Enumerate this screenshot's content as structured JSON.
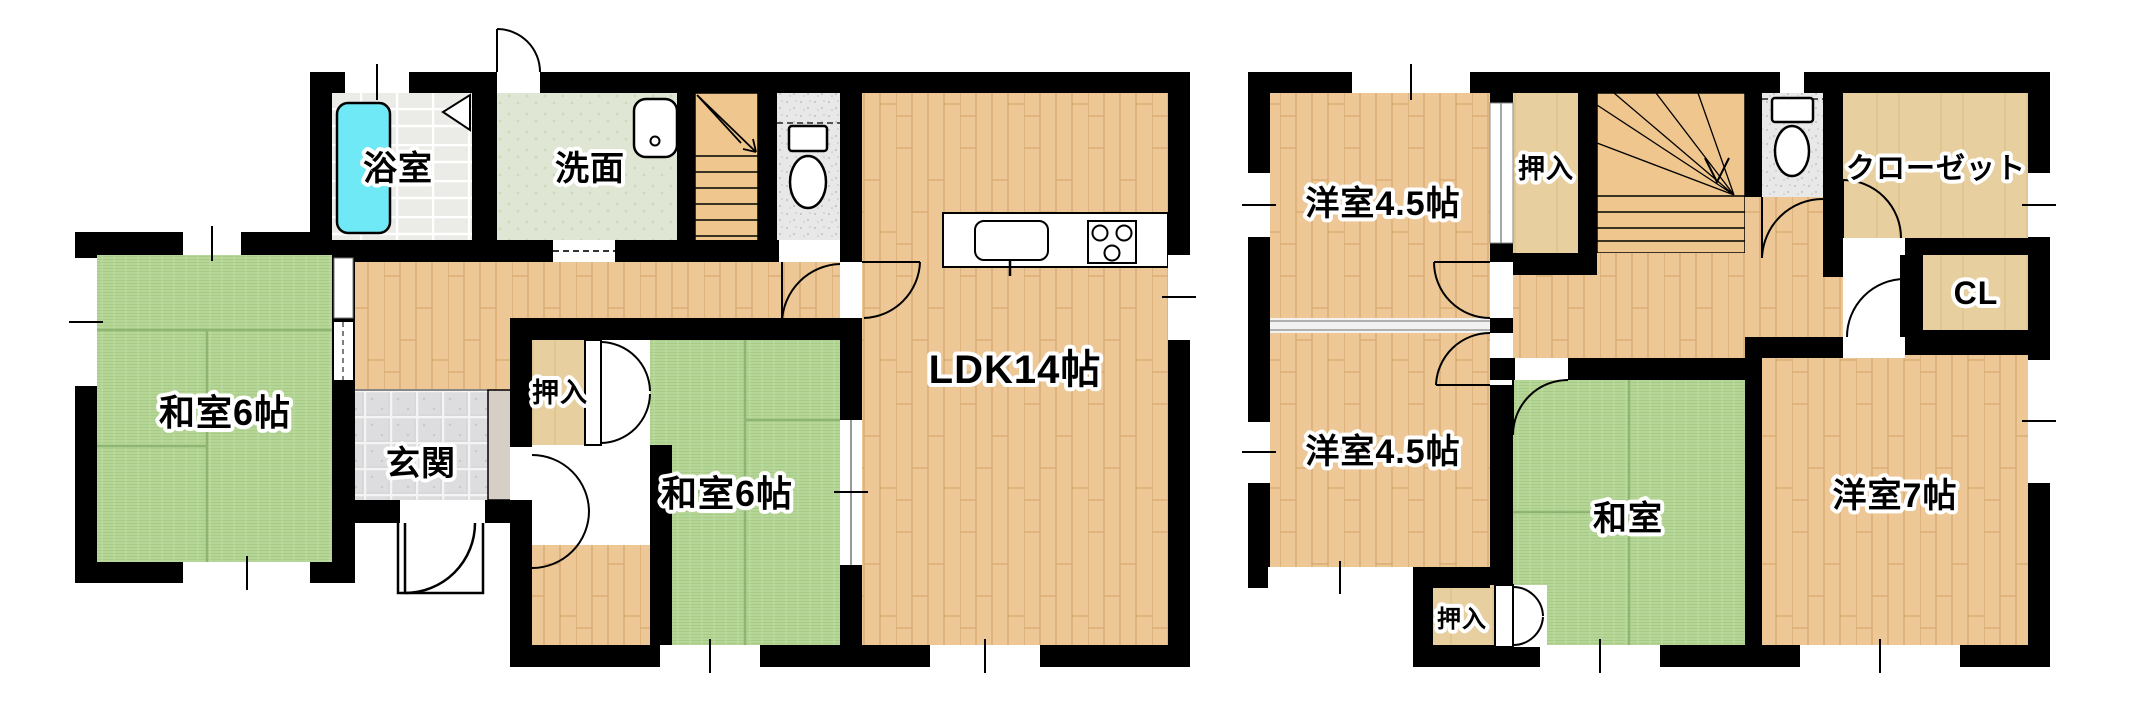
{
  "floor1": {
    "rooms": {
      "bath": "浴室",
      "washroom": "洗面",
      "tatami1": "和室6帖",
      "entrance": "玄関",
      "oshiire": "押入",
      "tatami2": "和室6帖",
      "ldk": "LDK14帖"
    }
  },
  "floor2": {
    "rooms": {
      "western_top": "洋室4.5帖",
      "oshiire_top": "押入",
      "walkin_closet": "クローゼット",
      "cl": "CL",
      "western_bottom": "洋室4.5帖",
      "tatami": "和室",
      "western7": "洋室7帖",
      "oshiire_bottom": "押入"
    }
  },
  "icons": {
    "bathtub": "bathtub-icon",
    "wash_sink": "wash-basin-icon",
    "toilet_1f": "toilet-icon",
    "toilet_2f": "toilet-icon",
    "stairs_1f": "stairs-up-icon",
    "stairs_2f": "stairs-down-icon",
    "kitchen_sink": "kitchen-sink-icon",
    "stove": "stove-burners-icon",
    "doors": "door-swing-icon",
    "windows": "window-icon"
  },
  "colors": {
    "wall": "#000000",
    "tatami": "#b5d697",
    "wood": "#edc795",
    "bathtub": "#6fe9f5",
    "closet_floor": "#e7cf9f",
    "entrance_tile": "#d8d8da",
    "stairs": "#efc68e",
    "washroom_floor": "#dfe6d3",
    "toilet_floor": "#e8e8e8"
  }
}
